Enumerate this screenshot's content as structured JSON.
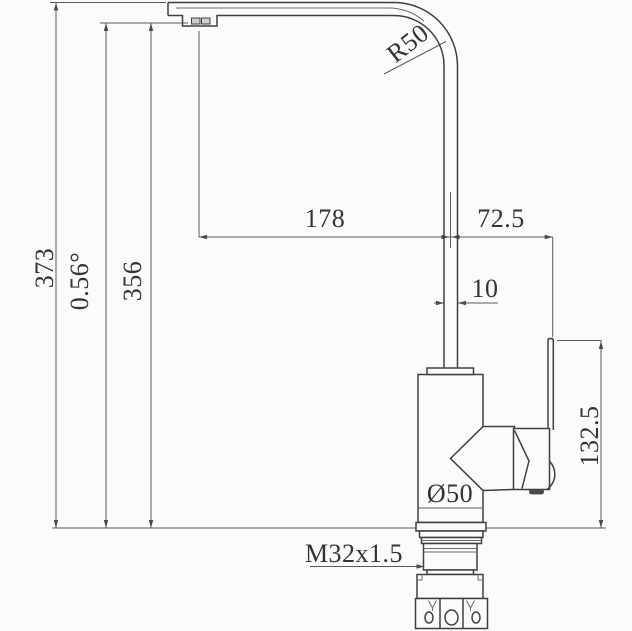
{
  "drawing": {
    "type": "faucet-technical-drawing",
    "labels": {
      "overall_height": "373",
      "spout_angle": "0.56°",
      "spout_outlet_height": "356",
      "bend_radius": "R50",
      "spout_reach": "178",
      "handle_offset": "72.5",
      "pipe_width": "10",
      "handle_top_height": "132.5",
      "body_diameter": "Ø50",
      "mounting_thread": "M32x1.5"
    },
    "colors": {
      "object_line": "#3f3f3f",
      "dimension_line": "#5a5a5a",
      "text": "#333333",
      "background": "#fbfbfb"
    }
  }
}
